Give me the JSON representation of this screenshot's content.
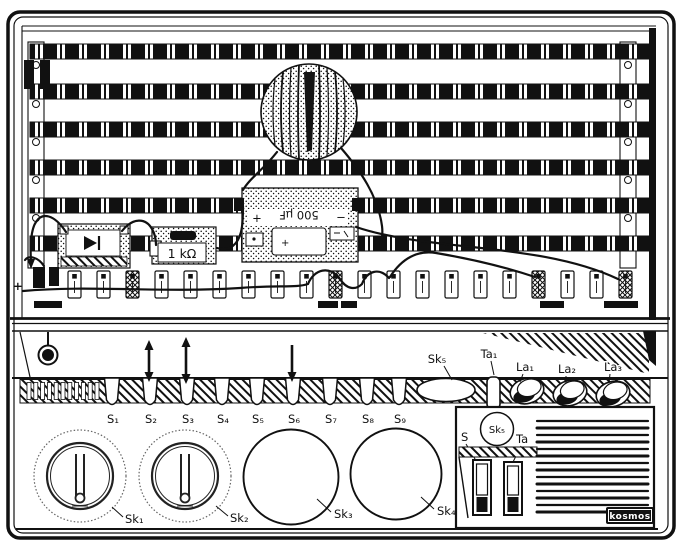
{
  "labels": {
    "plus": "+",
    "switches": [
      "S₁",
      "S₂",
      "S₃",
      "S₄",
      "S₅",
      "S₆",
      "S₇",
      "S₈",
      "S₉"
    ],
    "deck": {
      "sk5": "Sk₅",
      "ta1": "Ta₁",
      "la1": "La₁",
      "la2": "La₂",
      "la3": "La₃"
    },
    "knobs": [
      "Sk₁",
      "Sk₂",
      "Sk₃",
      "Sk₄"
    ],
    "panel": {
      "sk5": "Sk₅",
      "s": "S",
      "ta": "Ta"
    },
    "brand": "kosmos"
  },
  "components": {
    "capacitor": {
      "value": "500 µF",
      "plus": "+",
      "minus": "−",
      "body_plus": "+"
    },
    "resistor": {
      "value": "1 kΩ"
    }
  },
  "colors": {
    "ink": "#111111",
    "paper": "#ffffff"
  }
}
